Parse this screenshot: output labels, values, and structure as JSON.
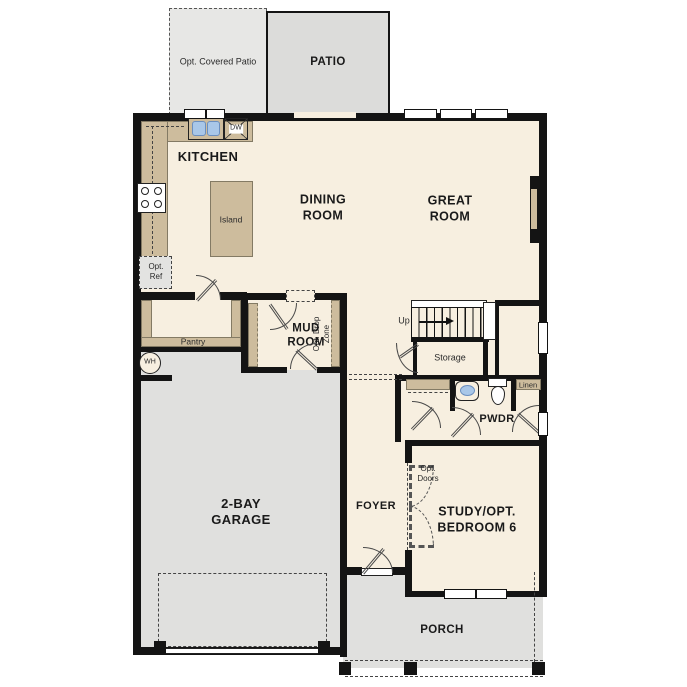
{
  "plan_type": "floor-plan",
  "rooms": {
    "patio": "PATIO",
    "covered_patio": "Opt. Covered Patio",
    "kitchen": "KITCHEN",
    "dining": "DINING\nROOM",
    "great": "GREAT\nROOM",
    "mud": "MUD\nROOM",
    "pwdr": "PWDR",
    "garage": "2-BAY\nGARAGE",
    "foyer": "FOYER",
    "study": "STUDY/OPT.\nBEDROOM 6",
    "porch": "PORCH"
  },
  "features": {
    "island": "Island",
    "dw": "DW",
    "opt_ref": "Opt.\nRef",
    "pantry": "Pantry",
    "wh": "WH",
    "drop_zone": "Opt. Drop\nZone",
    "up": "Up",
    "storage": "Storage",
    "linen": "Linen",
    "opt_doors": "Opt.\nDoors"
  },
  "colors": {
    "floor": "#f7efe0",
    "counter_tan": "#cdbc9d",
    "garage_gray": "#e0e0de",
    "patio_gray": "#dcdcda",
    "covered_patio_gray": "#e7e7e5",
    "wall_black": "#141414",
    "sink_blue": "#a9c7e8"
  }
}
